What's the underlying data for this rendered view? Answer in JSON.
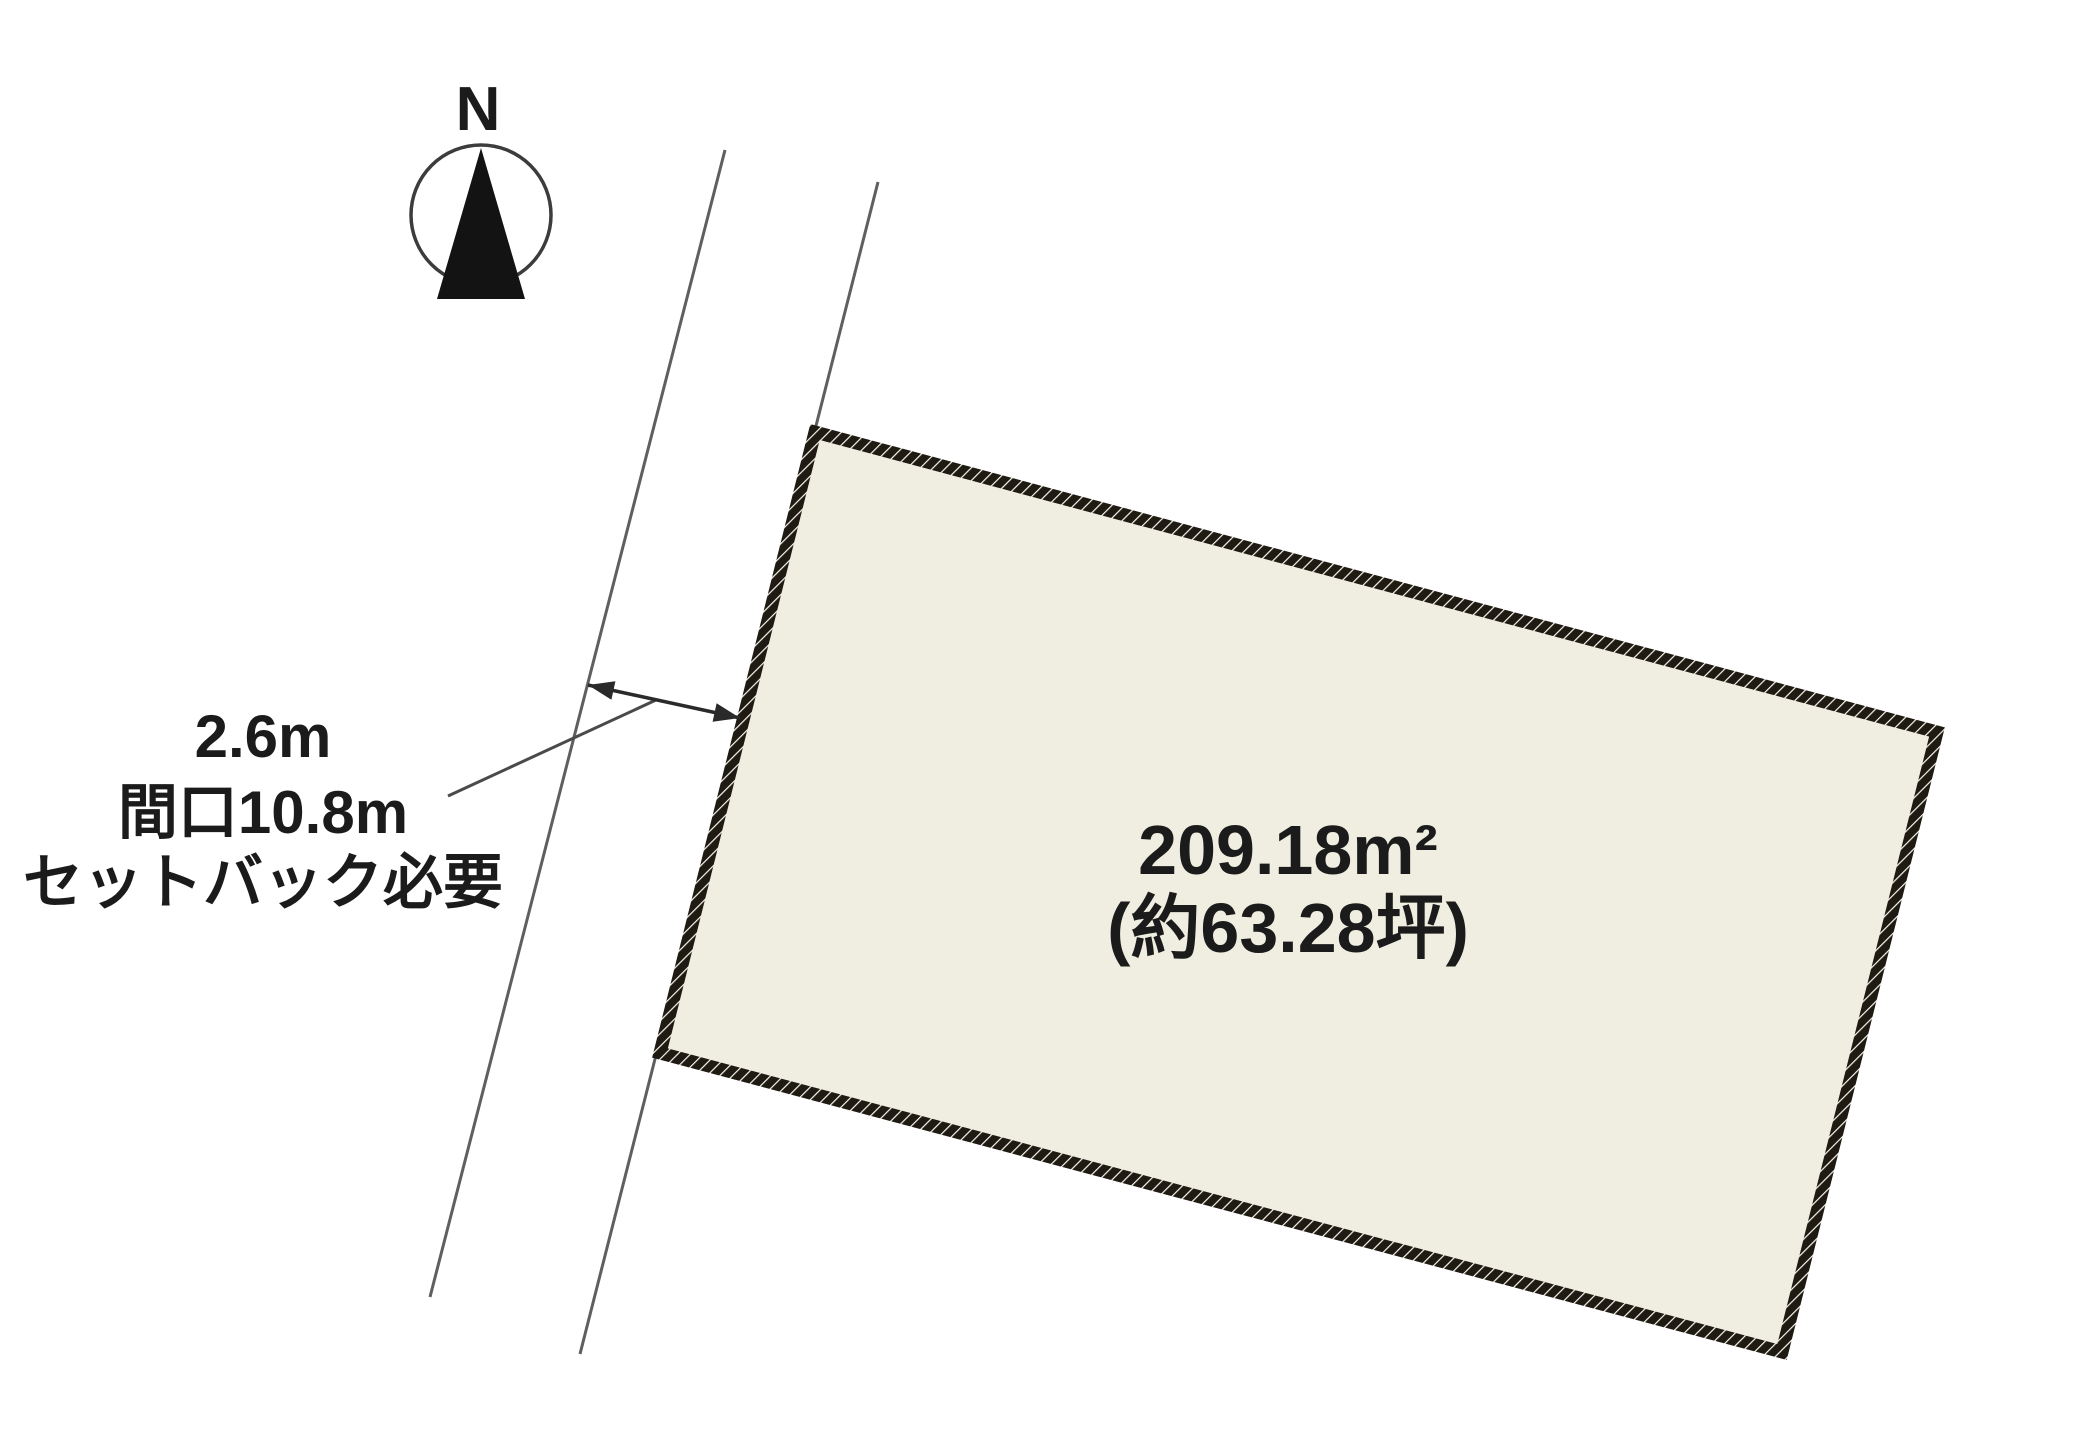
{
  "diagram": {
    "title": "land-plot-site-plan",
    "compass_label": "N",
    "parcel": {
      "area_m2": "209.18m²",
      "area_tsubo": "(約63.28坪)"
    },
    "annotations": {
      "road_width_label": "2.6m",
      "frontage_label": "間口10.8m",
      "setback_label": "セットバック必要"
    },
    "colors": {
      "parcel_fill": "#efeee1",
      "parcel_border": "#1f1a12",
      "hatch_gap": "#f7f6ef",
      "road_line": "#5f5f5f",
      "arrow": "#2a2a2a",
      "text": "#1b1b1b",
      "background": "#ffffff"
    }
  }
}
